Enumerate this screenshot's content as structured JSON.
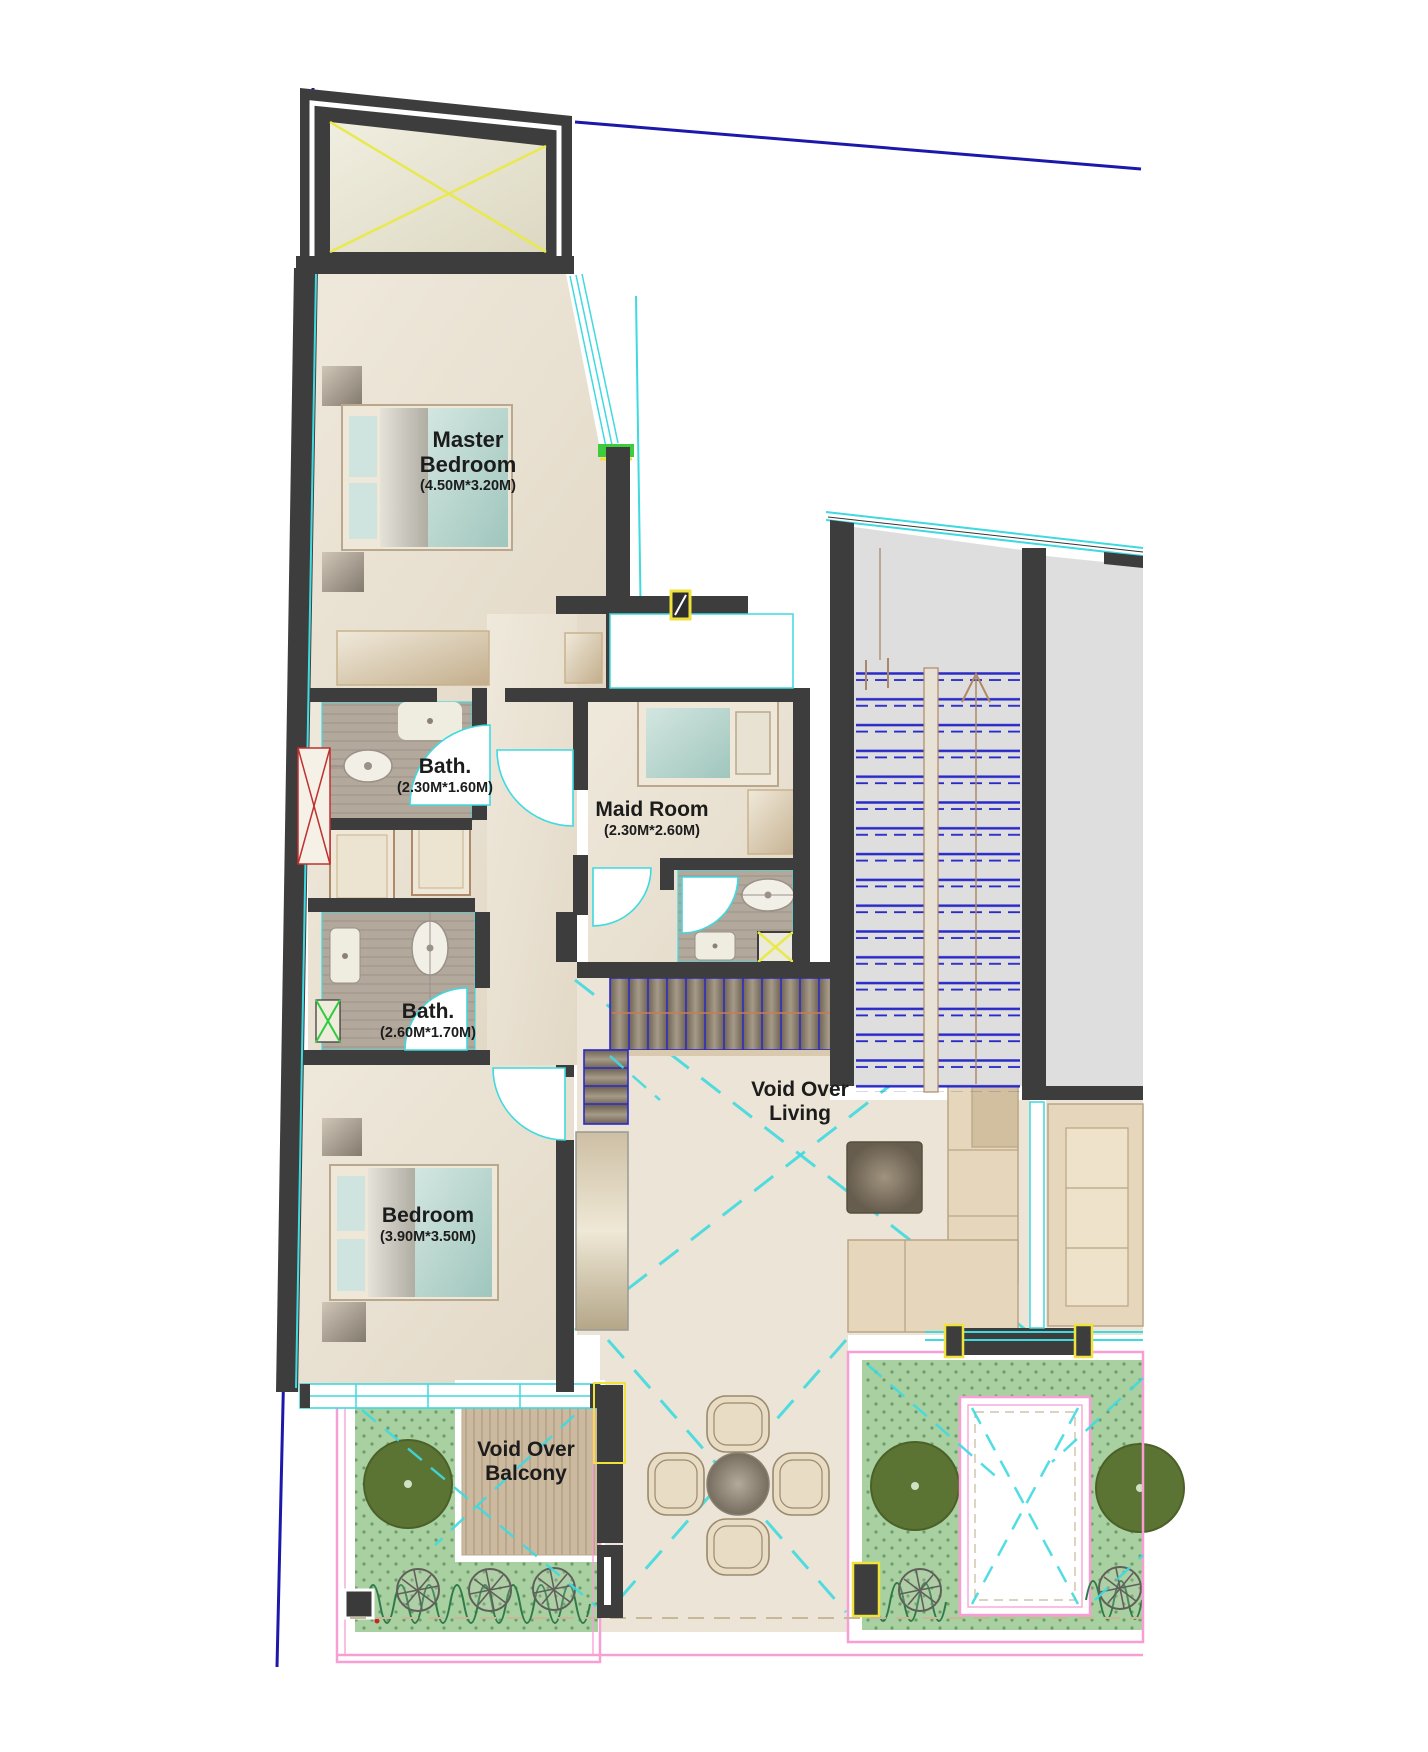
{
  "plan": {
    "type": "architectural-floor-plan",
    "rooms": {
      "master_bedroom": {
        "name": "Master Bedroom",
        "size": "(4.50M*3.20M)"
      },
      "master_bath": {
        "name": "Bath.",
        "size": "(2.30M*1.60M)"
      },
      "maid_room": {
        "name": "Maid Room",
        "size": "(2.30M*2.60M)"
      },
      "second_bath": {
        "name": "Bath.",
        "size": "(2.60M*1.70M)"
      },
      "bedroom": {
        "name": "Bedroom",
        "size": "(3.90M*3.50M)"
      },
      "void_over_living": {
        "name": "Void Over Living"
      },
      "void_over_balcony": {
        "name": "Void Over Balcony"
      }
    },
    "colors": {
      "wall": "#3d3d3d",
      "floor": "#eae2d4",
      "bathfloor": "#b3a89c",
      "glass": "#3fd9e0",
      "stairblue": "#2a2ac8",
      "boundary": "#1b18aa",
      "grass": "#a8d0a0",
      "tree": "#5b7433",
      "deck": "#ccbaa0",
      "grayarea": "#dedede",
      "pink": "#f79fd5",
      "yellow": "#f0e23c",
      "label": "#1c1c1c"
    }
  }
}
